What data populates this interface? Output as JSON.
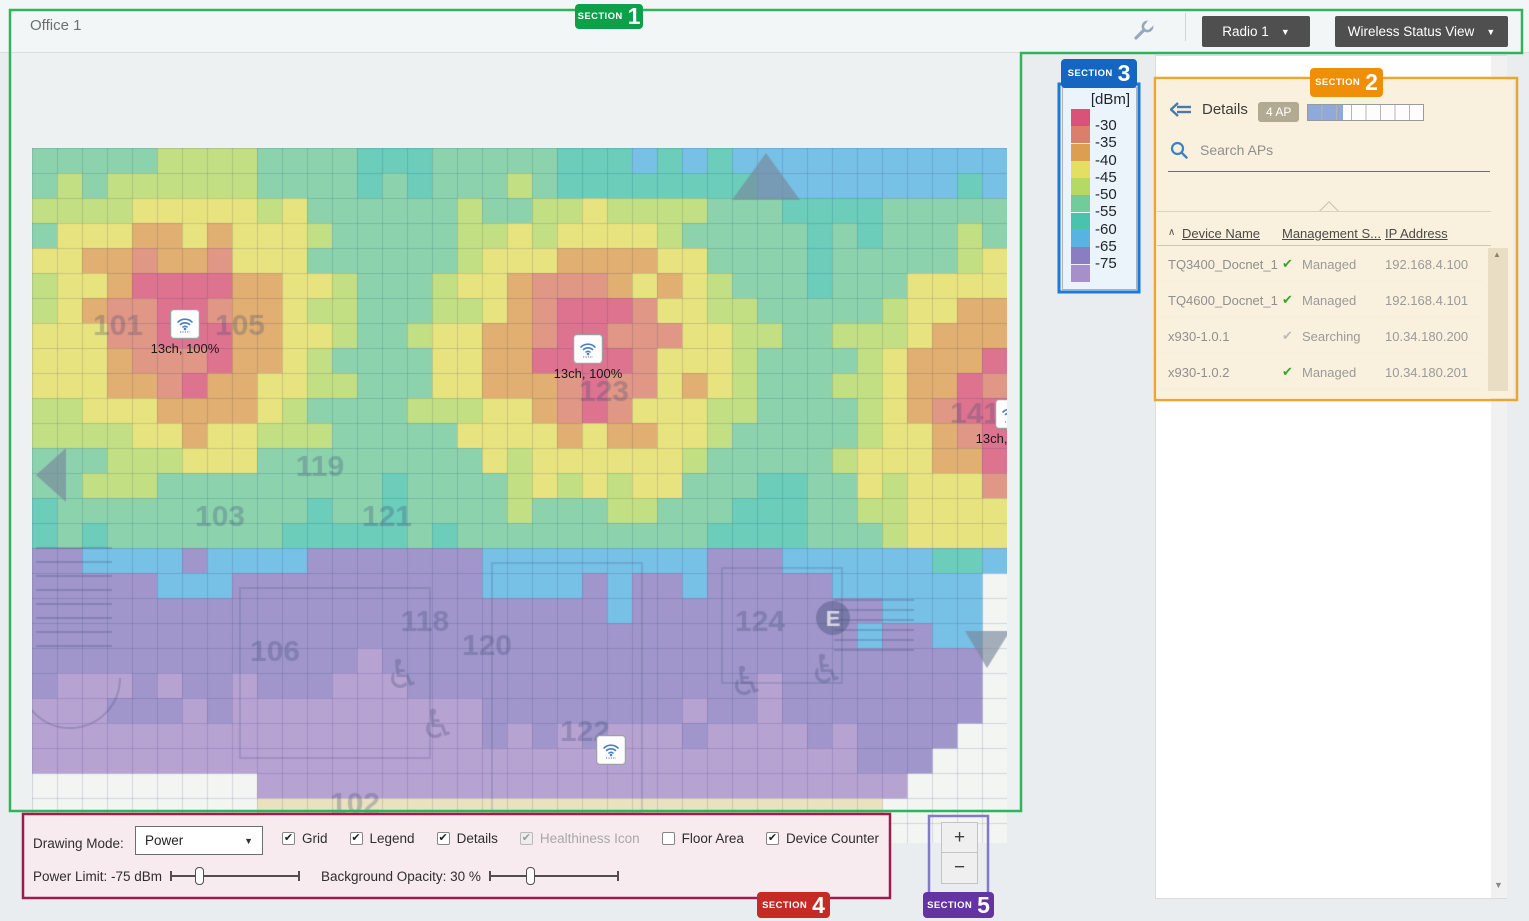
{
  "header": {
    "title": "Office 1",
    "radio_select": "Radio 1",
    "view_select": "Wireless Status View",
    "caret": "▼"
  },
  "sections": [
    {
      "label": "SECTION",
      "num": "1",
      "badge": "#0aa149",
      "border": "#2eb45a"
    },
    {
      "label": "SECTION",
      "num": "2",
      "badge": "#ef8e07",
      "border": "#eda62d"
    },
    {
      "label": "SECTION",
      "num": "3",
      "badge": "#1566c0",
      "border": "#1d79d8"
    },
    {
      "label": "SECTION",
      "num": "4",
      "badge": "#c32b24",
      "border": "#a01a4e"
    },
    {
      "label": "SECTION",
      "num": "5",
      "badge": "#6434a2",
      "border": "#8279cf"
    }
  ],
  "legend": {
    "title": "[dBm]",
    "entries": [
      {
        "label": "-30",
        "color": "#d85377"
      },
      {
        "label": "-35",
        "color": "#db7f6a"
      },
      {
        "label": "-40",
        "color": "#dc9e50"
      },
      {
        "label": "-45",
        "color": "#e3df62"
      },
      {
        "label": "-50",
        "color": "#b6d966"
      },
      {
        "label": "-55",
        "color": "#72cb9b"
      },
      {
        "label": "-60",
        "color": "#49c3ab"
      },
      {
        "label": "-65",
        "color": "#57b3e2"
      },
      {
        "label": "-75",
        "color": "#8b7ec0"
      },
      {
        "label": "",
        "color": "#a78fc9"
      }
    ]
  },
  "map": {
    "cell": 25,
    "bands_px": [
      45,
      70,
      95,
      142,
      167,
      242,
      335,
      430,
      560
    ],
    "wall_y": 395,
    "wall_penalty": 180,
    "top_penalty": 120,
    "floor_tint": "#e6dcb2",
    "blank_color": "#f3f5f2",
    "aps": [
      {
        "id": "ap-1",
        "x": 138,
        "y": 161,
        "cx": 153,
        "cy": 176,
        "label": "13ch, 100%",
        "active": true
      },
      {
        "id": "ap-2",
        "x": 541,
        "y": 186,
        "cx": 556,
        "cy": 201,
        "label": "13ch, 100%",
        "active": true
      },
      {
        "id": "ap-3",
        "x": 963,
        "y": 251,
        "cx": 978,
        "cy": 266,
        "label": "13ch, 100%",
        "active": true
      },
      {
        "id": "ap-4",
        "x": 564,
        "y": 587,
        "cx": 579,
        "cy": 602,
        "label": "",
        "active": false
      }
    ],
    "rooms": [
      {
        "label": "101",
        "x": 86,
        "y": 187
      },
      {
        "label": "105",
        "x": 208,
        "y": 187
      },
      {
        "label": "123",
        "x": 572,
        "y": 253
      },
      {
        "label": "119",
        "x": 288,
        "y": 328
      },
      {
        "label": "103",
        "x": 188,
        "y": 378
      },
      {
        "label": "121",
        "x": 355,
        "y": 378
      },
      {
        "label": "141",
        "x": 943,
        "y": 275
      },
      {
        "label": "118",
        "x": 393,
        "y": 483
      },
      {
        "label": "120",
        "x": 455,
        "y": 507
      },
      {
        "label": "106",
        "x": 243,
        "y": 513
      },
      {
        "label": "124",
        "x": 728,
        "y": 483
      },
      {
        "label": "122",
        "x": 553,
        "y": 593
      },
      {
        "label": "102",
        "x": 323,
        "y": 665
      }
    ],
    "wheelchair_glyph": "♿",
    "wheelchairs": [
      {
        "x": 371,
        "y": 540
      },
      {
        "x": 406,
        "y": 590
      },
      {
        "x": 715,
        "y": 547
      },
      {
        "x": 795,
        "y": 535
      }
    ],
    "elevator": {
      "glyph": "E",
      "x": 801,
      "y": 470
    },
    "nav_triangles": [
      {
        "points": [
          [
            34,
            300
          ],
          [
            34,
            354
          ],
          [
            4,
            327
          ]
        ]
      },
      {
        "points": [
          [
            700,
            52
          ],
          [
            768,
            52
          ],
          [
            734,
            5
          ]
        ]
      },
      {
        "points": [
          [
            933,
            483
          ],
          [
            978,
            483
          ],
          [
            955,
            520
          ]
        ]
      }
    ]
  },
  "details_panel": {
    "back_label": "Details",
    "ap_count": "4 AP",
    "progress_ratio": 0.3,
    "search_placeholder": "Search APs",
    "table": {
      "sort_caret": "∧",
      "columns": [
        "Device Name",
        "Management S...",
        "IP Address"
      ],
      "rows": [
        {
          "name": "TQ3400_Docnet_1",
          "status": "Managed",
          "ok": true,
          "ip": "192.168.4.100"
        },
        {
          "name": "TQ4600_Docnet_1",
          "status": "Managed",
          "ok": true,
          "ip": "192.168.4.101"
        },
        {
          "name": "x930-1.0.1",
          "status": "Searching",
          "ok": false,
          "ip": "10.34.180.200"
        },
        {
          "name": "x930-1.0.2",
          "status": "Managed",
          "ok": true,
          "ip": "10.34.180.201"
        }
      ]
    },
    "check_glyph": "✔",
    "scroll_up_glyph": "▲",
    "scroll_down_glyph": "▼"
  },
  "toolbar": {
    "drawing_mode_label": "Drawing Mode:",
    "drawing_mode_value": "Power",
    "caret": "▼",
    "check_glyph": "✔",
    "checkboxes": [
      {
        "label": "Grid",
        "checked": true,
        "enabled": true
      },
      {
        "label": "Legend",
        "checked": true,
        "enabled": true
      },
      {
        "label": "Details",
        "checked": true,
        "enabled": true
      },
      {
        "label": "Healthiness Icon",
        "checked": true,
        "enabled": false
      },
      {
        "label": "Floor Area",
        "checked": false,
        "enabled": true
      },
      {
        "label": "Device Counter",
        "checked": true,
        "enabled": true
      }
    ],
    "sliders": [
      {
        "name": "power-limit",
        "label": "Power Limit: -75 dBm",
        "pct": 22
      },
      {
        "name": "background-opacity",
        "label": "Background Opacity: 30 %",
        "pct": 32
      }
    ]
  },
  "zoom_controls": {
    "zoom_in": "+",
    "zoom_out": "−"
  }
}
